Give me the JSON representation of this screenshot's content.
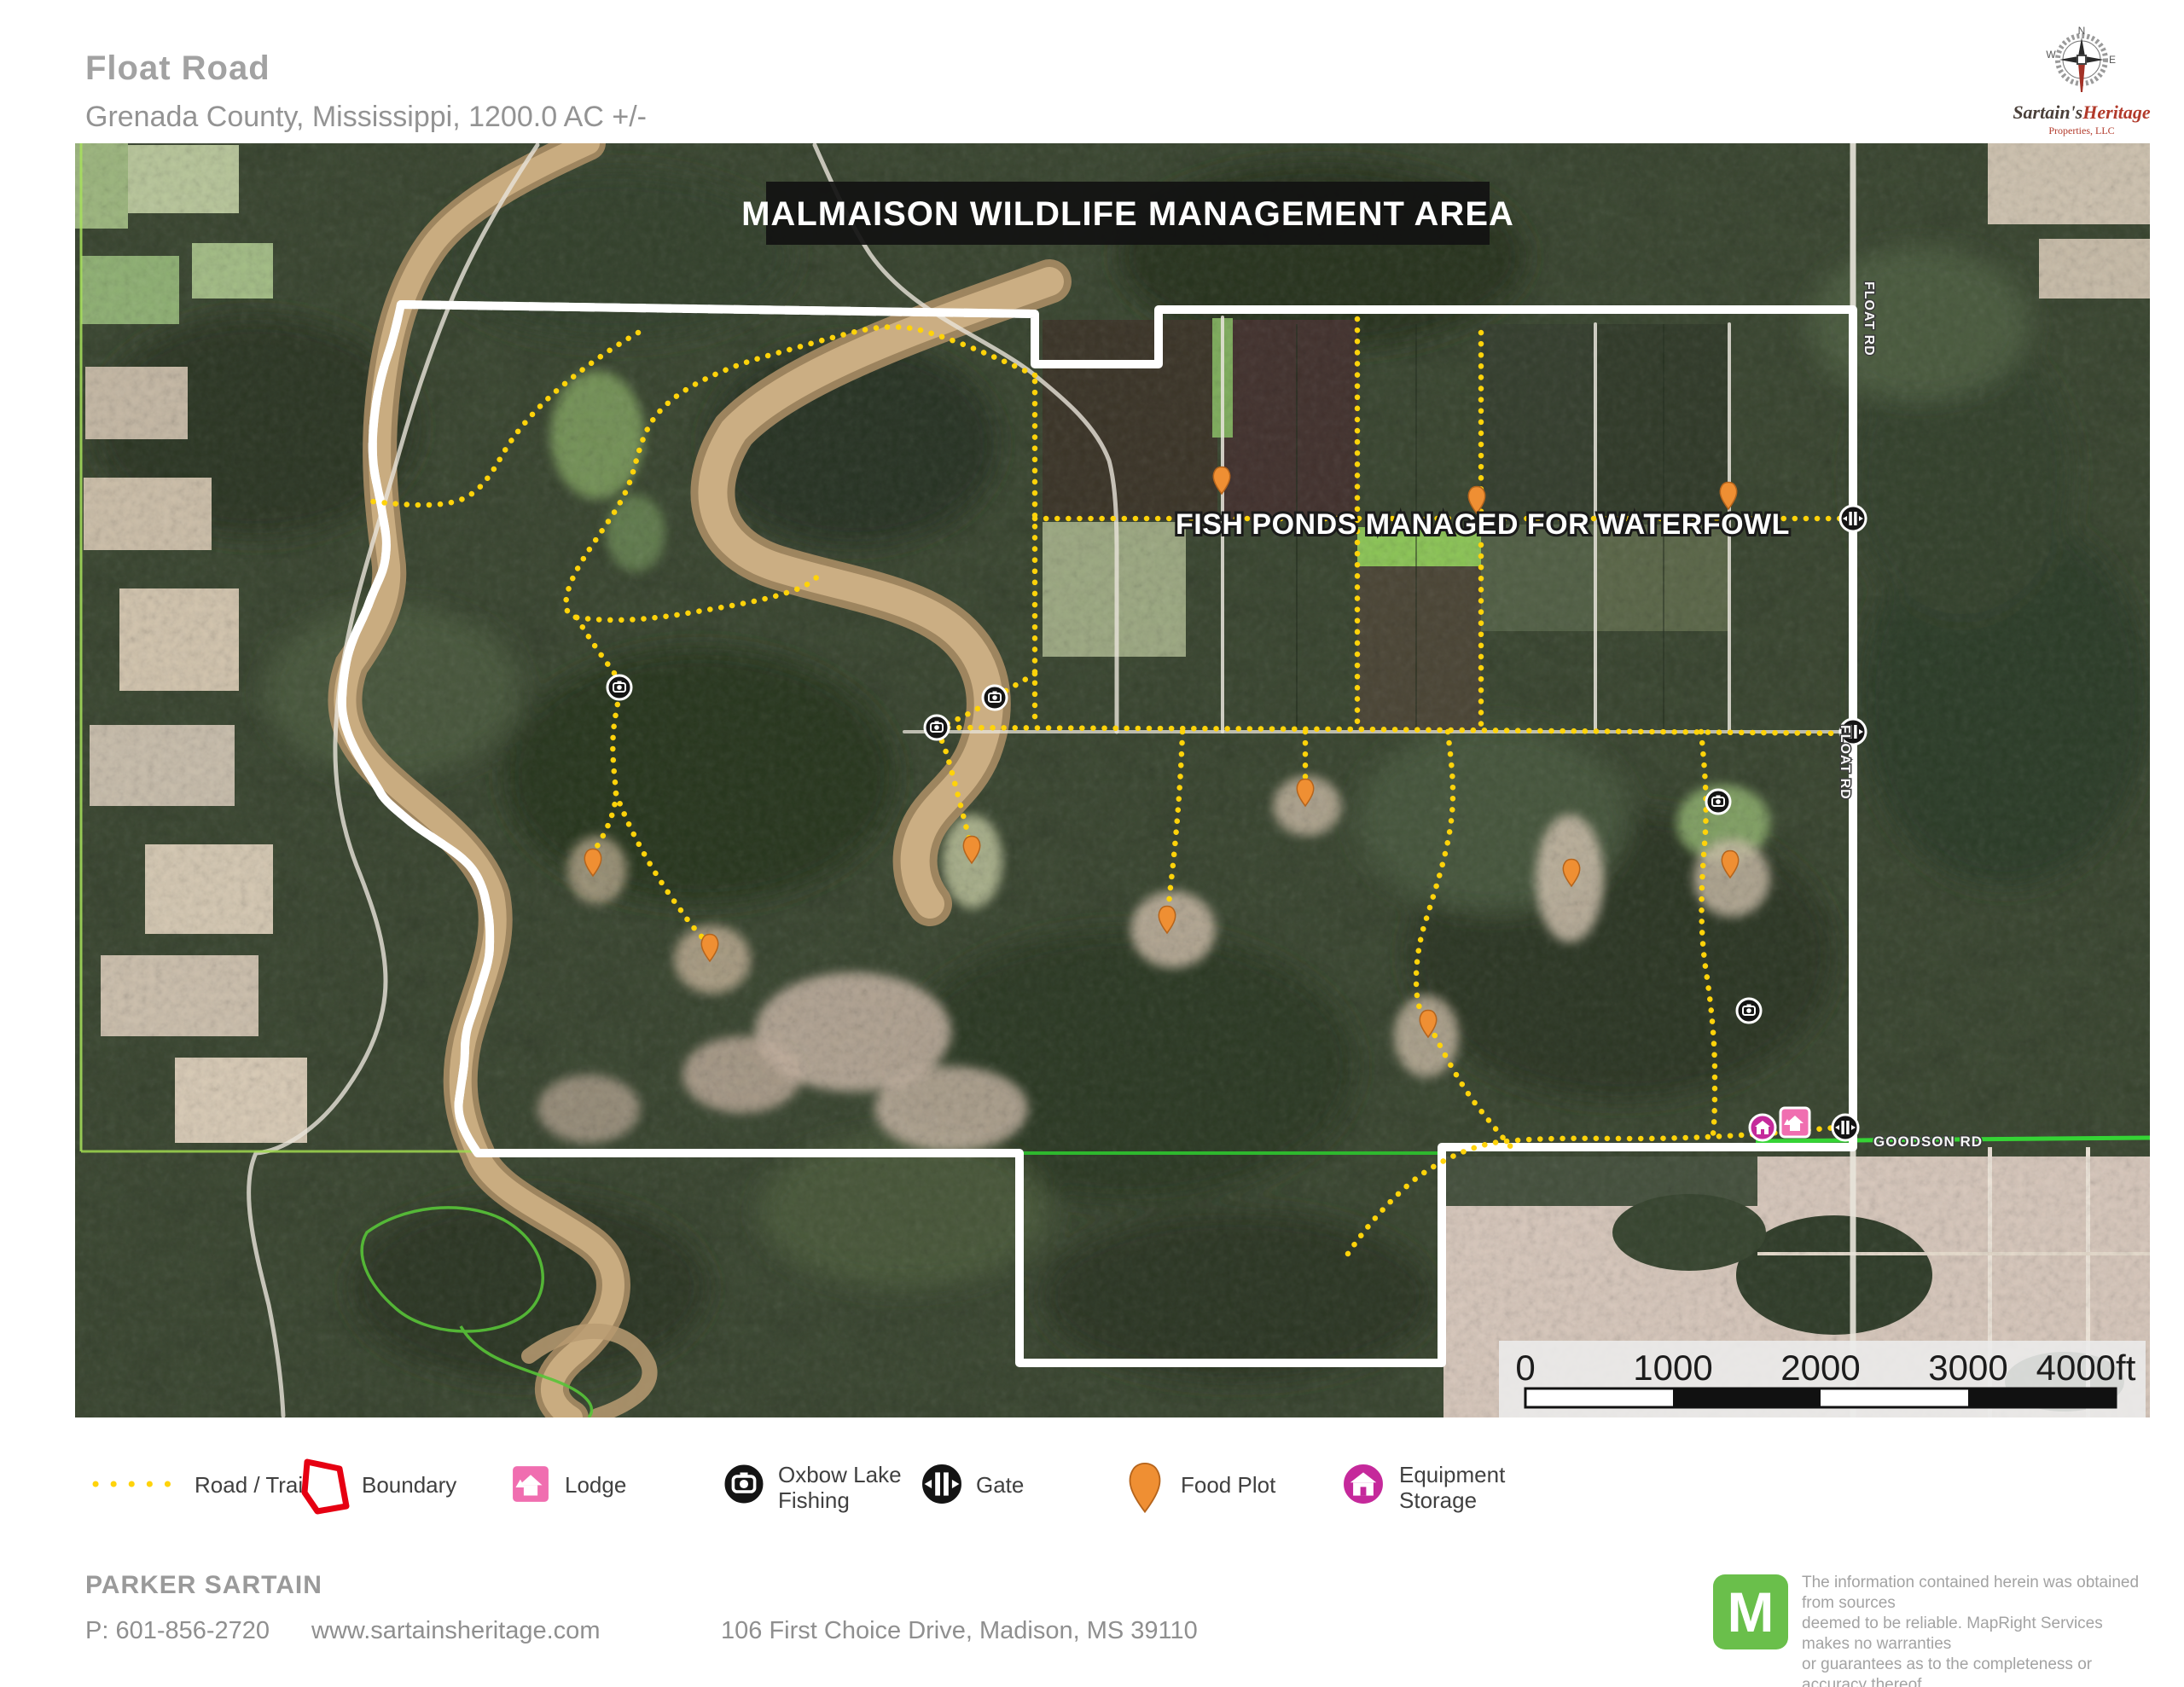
{
  "header": {
    "title": "Float Road",
    "subtitle": "Grenada County, Mississippi, 1200.0  AC +/-"
  },
  "logo": {
    "name_primary": "Sartain's",
    "name_secondary": "Heritage",
    "subtitle": "Properties, LLC",
    "compass": {
      "n": "N",
      "w": "W",
      "e": "E"
    }
  },
  "map": {
    "banner": "MALMAISON WILDLIFE MANAGEMENT AREA",
    "fish_ponds_label": "FISH PONDS MANAGED FOR WATERFOWL",
    "road_labels": {
      "float_rd": "FLOAT RD",
      "goodson_rd": "GOODSON RD"
    },
    "scale_bar": {
      "ticks": [
        "0",
        "1000",
        "2000",
        "3000",
        "4000ft"
      ]
    }
  },
  "legend": {
    "items": [
      {
        "label": "Road / Trail"
      },
      {
        "label": "Boundary"
      },
      {
        "label": "Lodge"
      },
      {
        "label": "Oxbow Lake Fishing",
        "line1": "Oxbow Lake",
        "line2": "Fishing"
      },
      {
        "label": "Gate"
      },
      {
        "label": "Food Plot"
      },
      {
        "label": "Equipment Storage",
        "line1": "Equipment",
        "line2": "Storage"
      }
    ]
  },
  "footer": {
    "agent": "PARKER SARTAIN",
    "phone": "P: 601-856-2720",
    "website": "www.sartainsheritage.com",
    "address": "106 First Choice Drive, Madison, MS 39110"
  },
  "disclaimer": {
    "badge_letter": "M",
    "lines": [
      "The information contained herein was obtained from sources",
      "deemed to be reliable. MapRight Services makes no warranties",
      "or guarantees as to the completeness or accuracy thereof.",
      "844.932.6277 - mapright.com"
    ]
  },
  "colors": {
    "boundary_red": "#e60012",
    "trail_yellow": "#ffd30a",
    "section_green": "#9fd84f",
    "road_green": "#35d435",
    "food_plot_orange": "#ef8f33",
    "lodge_pink": "#f06eb0",
    "equipment_magenta": "#c5299b",
    "mapright_green": "#6abf4b"
  }
}
